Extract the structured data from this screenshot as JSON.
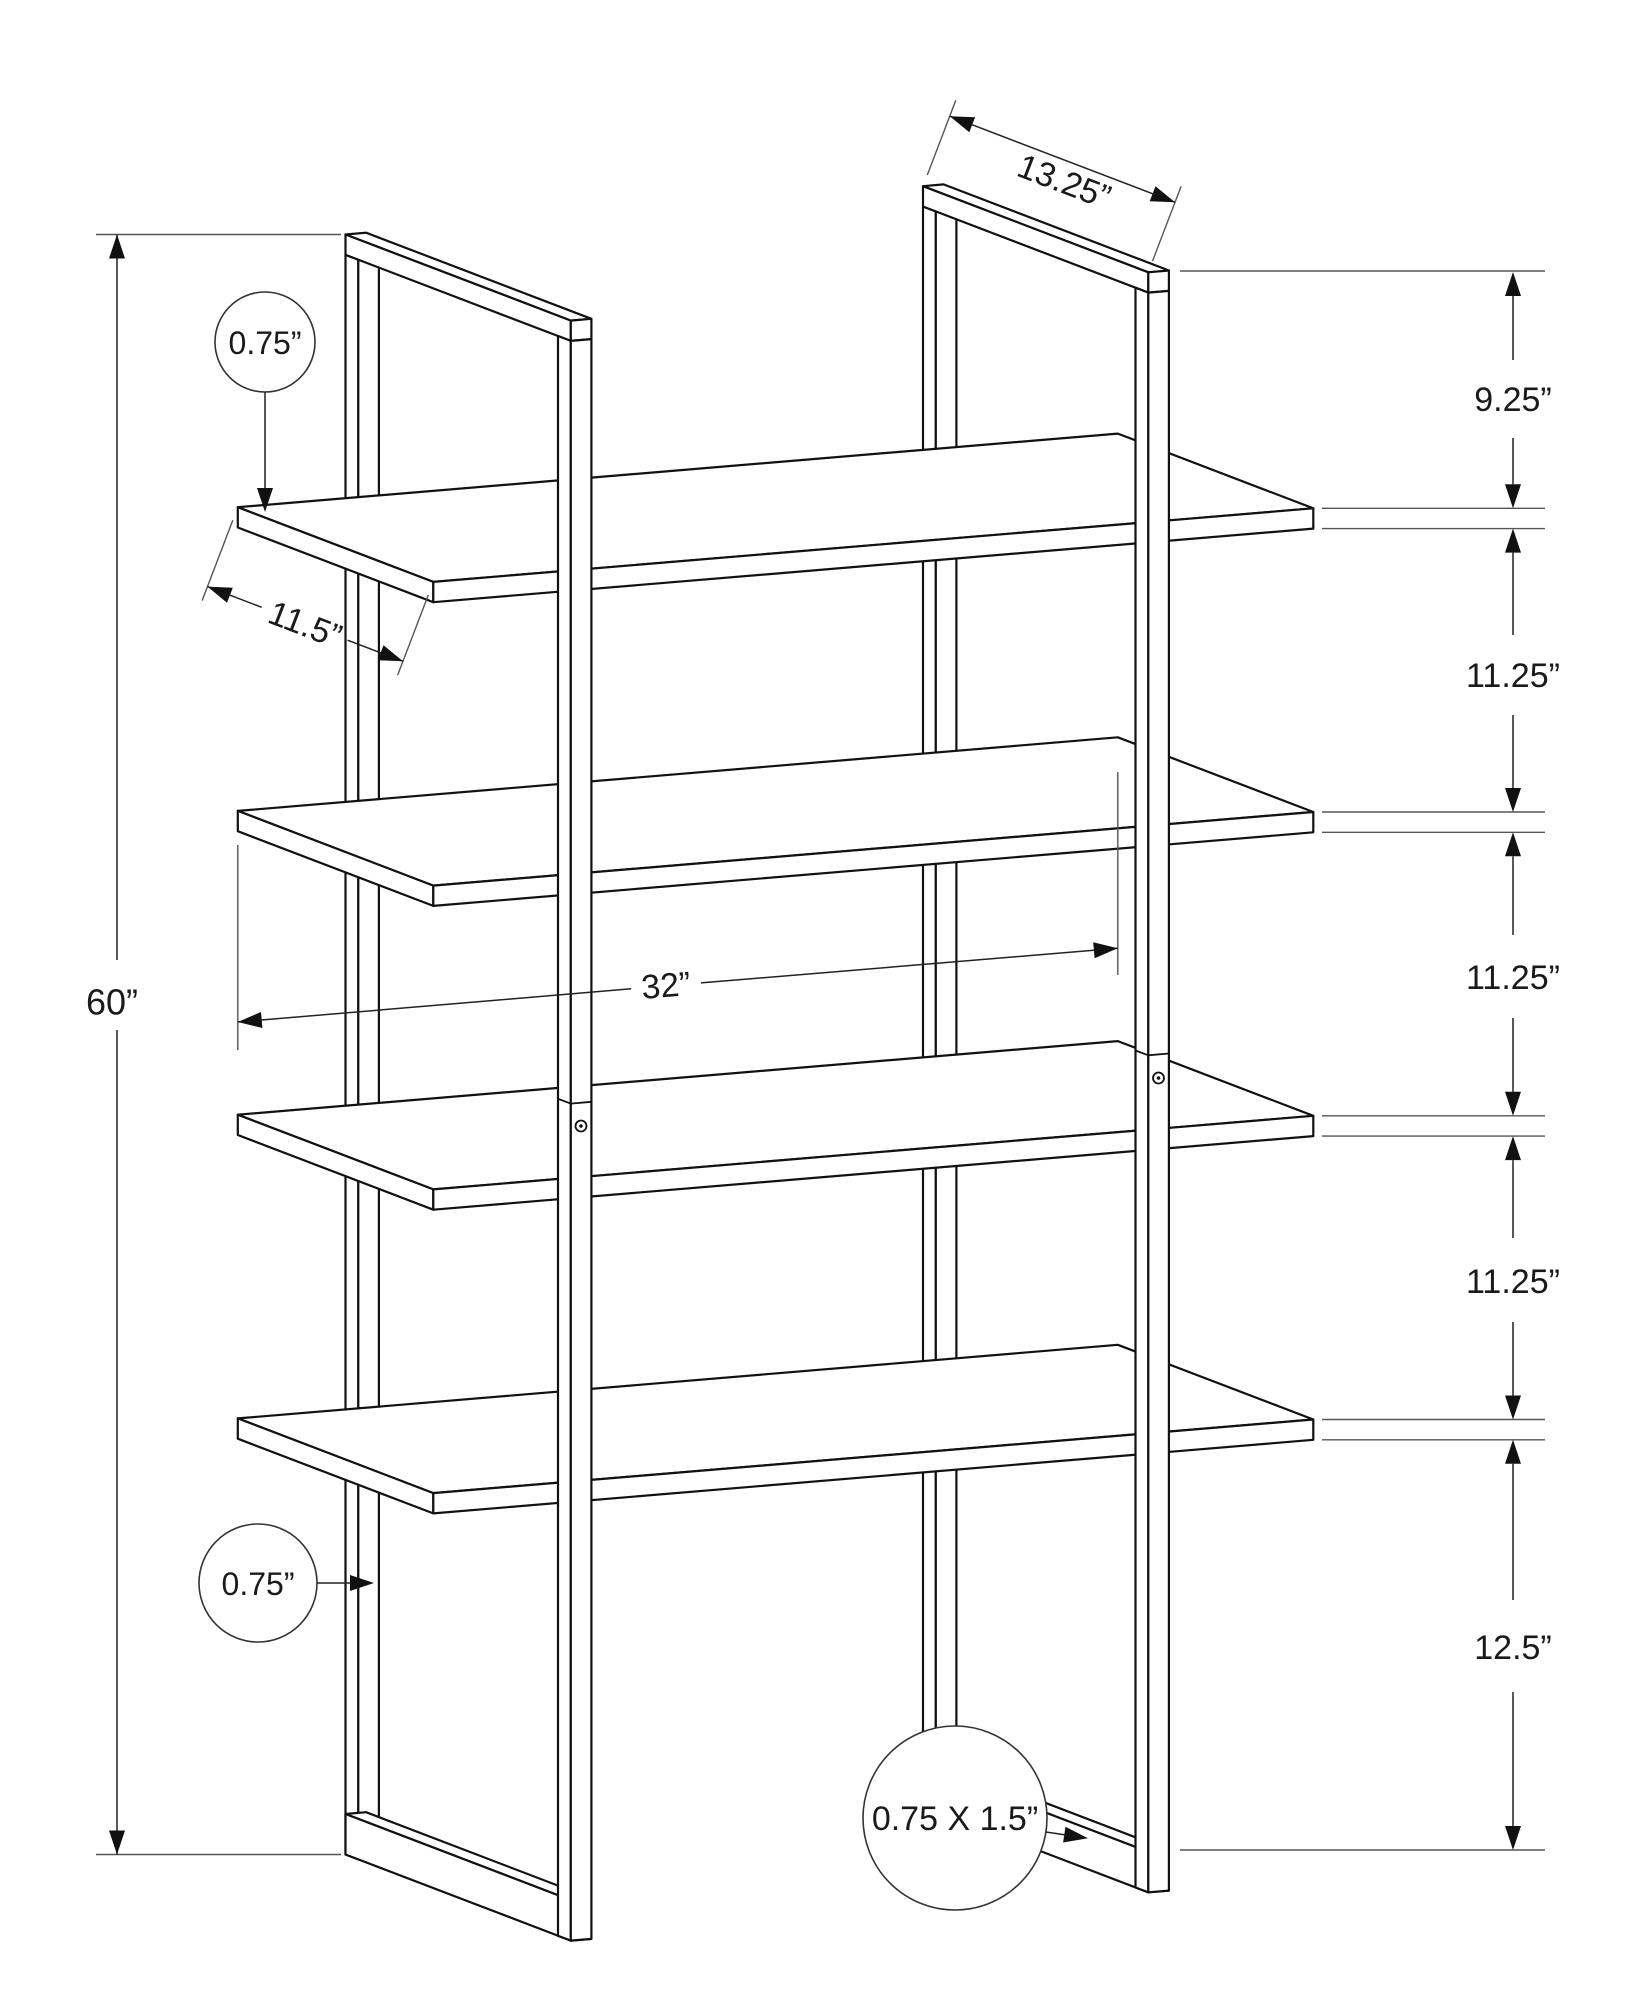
{
  "diagram": {
    "title": "bookshelf-dimension-drawing",
    "line_color": "#111111",
    "background": "#ffffff",
    "dims": {
      "depth": "13.25”",
      "height": "60”",
      "top_gap": "9.25”",
      "gap1": "11.25”",
      "gap2": "11.25”",
      "gap3": "11.25”",
      "bottom_gap": "12.5”",
      "shelf_thickness": "0.75”",
      "shelf_depth": "11.5”",
      "shelf_width": "32”",
      "post_size": "0.75”",
      "base_rail": "0.75 X 1.5”"
    }
  }
}
